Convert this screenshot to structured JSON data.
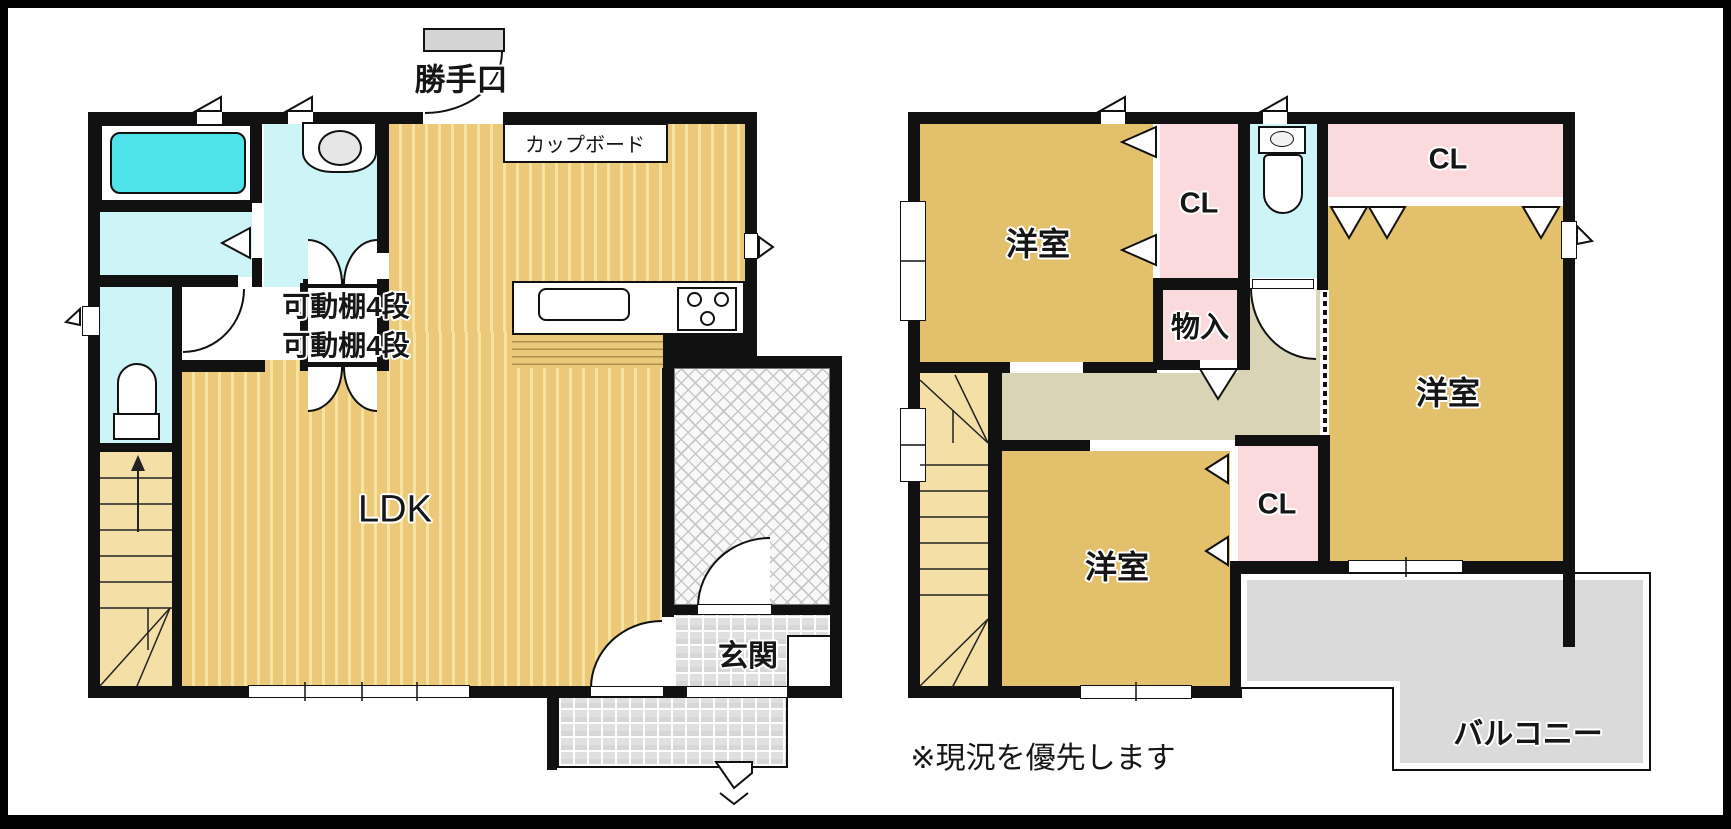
{
  "page": {
    "background": "#ffffff",
    "frame_color": "#000000"
  },
  "plan1": {
    "name": "first-floor",
    "labels": {
      "back_door": "勝手口",
      "cupboard": "カップボード",
      "movable_shelf_1": "可動棚4段",
      "movable_shelf_2": "可動棚4段",
      "ldk": "LDK",
      "entrance": "玄関"
    }
  },
  "plan2": {
    "name": "second-floor",
    "labels": {
      "bedroom_northwest": "洋室",
      "bedroom_east": "洋室",
      "bedroom_south": "洋室",
      "closet_west": "CL",
      "closet_east": "CL",
      "closet_middle": "CL",
      "storage": "物入",
      "balcony": "バルコニー"
    }
  },
  "footnote": "※現況を優先します",
  "colors": {
    "wall": "#111111",
    "ldk_floor": "#ebc979",
    "ldk_stripe": "#f6e3a2",
    "room_floor": "#e3c06c",
    "stairs_floor": "#f4e0a6",
    "hall_floor": "#d9d4b6",
    "closet_pink": "#fbdade",
    "wet_area_cyan": "#cdf4f7",
    "bathtub_cyan": "#4fe2e8",
    "balcony_gray": "#dadada",
    "door_leaf_gray": "#d4d4d4"
  }
}
